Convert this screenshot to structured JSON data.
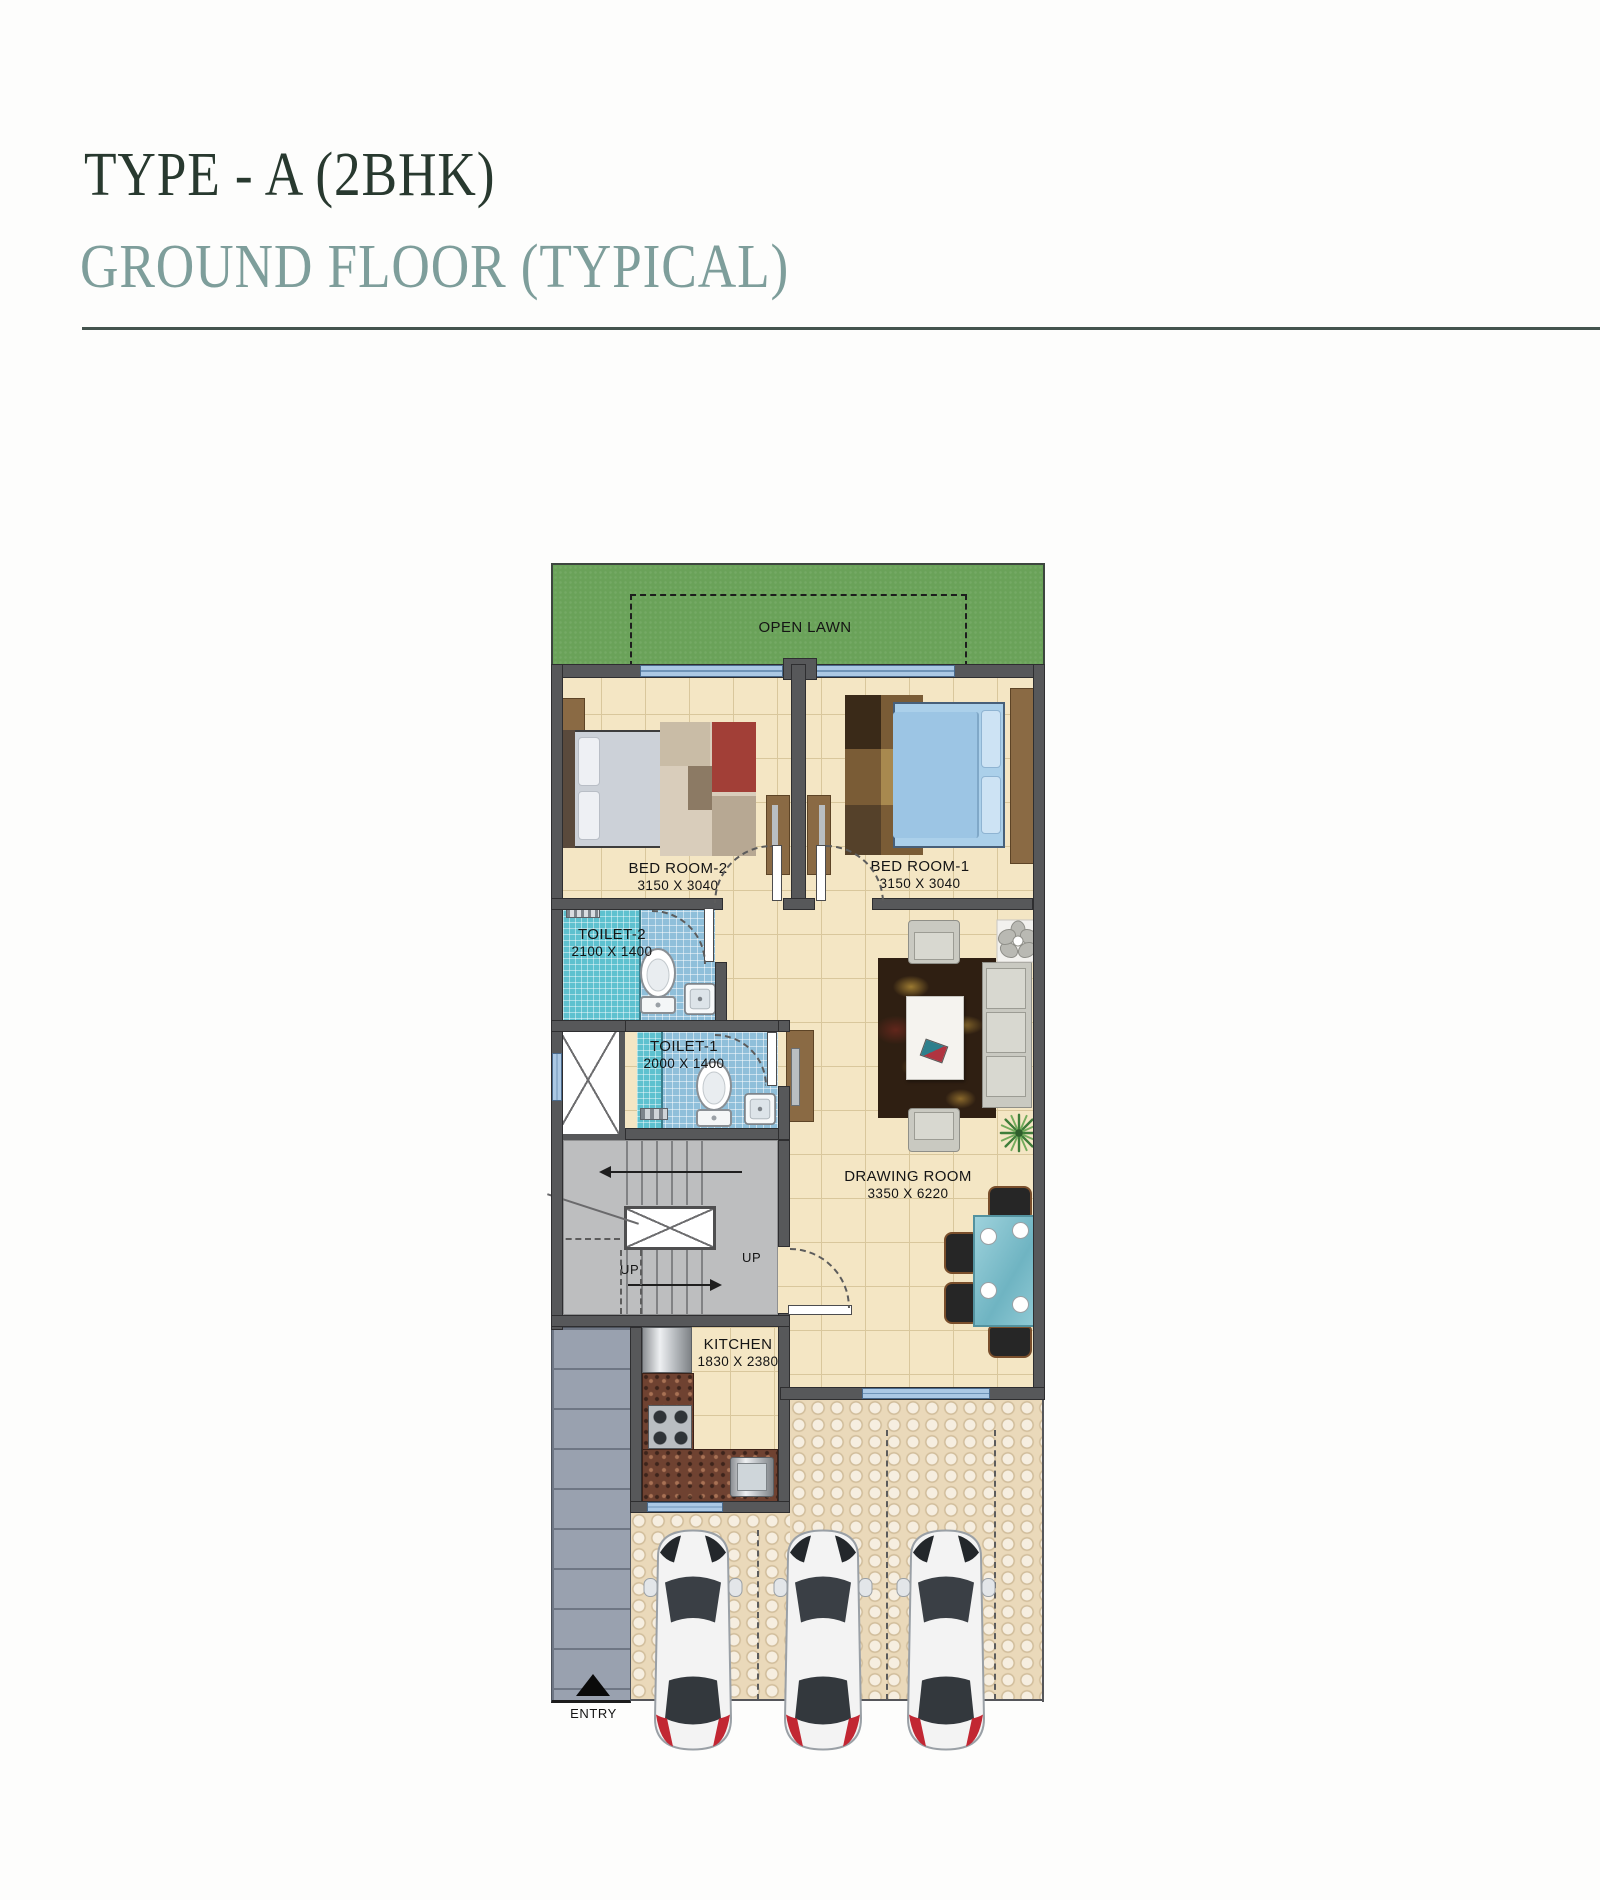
{
  "header": {
    "title": "TYPE - A (2BHK)",
    "subtitle": "GROUND FLOOR (TYPICAL)"
  },
  "plan": {
    "lawn_label": "OPEN LAWN",
    "rooms": {
      "bedroom2": {
        "name": "BED ROOM-2",
        "dims": "3150 X 3040"
      },
      "bedroom1": {
        "name": "BED ROOM-1",
        "dims": "3150 X 3040"
      },
      "toilet2": {
        "name": "TOILET-2",
        "dims": "2100 X 1400"
      },
      "toilet1": {
        "name": "TOILET-1",
        "dims": "2000 X 1400"
      },
      "drawing": {
        "name": "DRAWING ROOM",
        "dims": "3350 X 6220"
      },
      "kitchen": {
        "name": "KITCHEN",
        "dims": "1830 X 2380"
      }
    },
    "stairs": {
      "up_left": "UP",
      "up_right": "UP"
    },
    "entry_label": "ENTRY",
    "parking": {
      "car_count": 3
    }
  },
  "colors": {
    "title": "#28392f",
    "subtitle": "#7e9e9b",
    "rule": "#44544e",
    "lawn": "#6aa259",
    "wall": "#57585a",
    "window": "#abc8e4",
    "floor": "#f4e6c4",
    "toilet_tile": "#8fbfda",
    "stair": "#bdbebf",
    "granite": "#6f4231",
    "brick": "#99a1af",
    "paver": "#ead9ba",
    "car_accent_red": "#c22733"
  }
}
